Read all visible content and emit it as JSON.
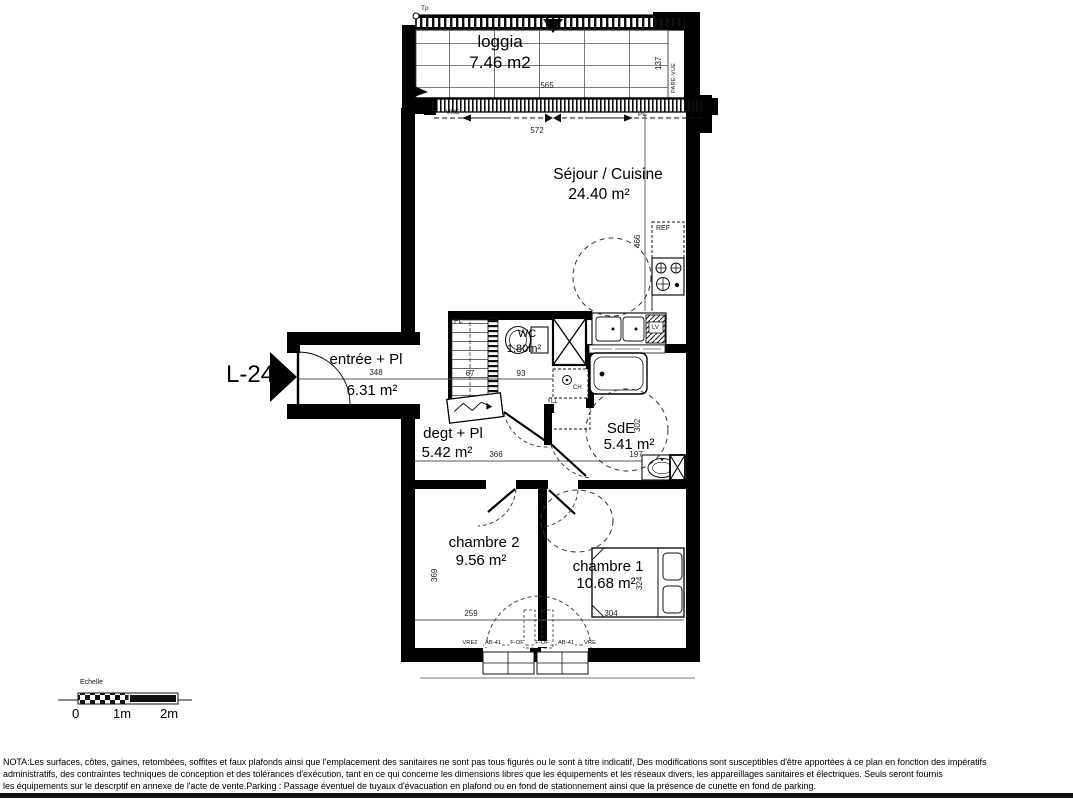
{
  "unit": "L-24",
  "rooms": {
    "loggia": {
      "name": "loggia",
      "area": "7.46 m2"
    },
    "sejour": {
      "name": "Séjour / Cuisine",
      "area": "24.40 m²"
    },
    "entree": {
      "name": "entrée + Pl",
      "area": "6.31 m²"
    },
    "wc": {
      "name": "WC",
      "area": "1.80m²"
    },
    "degt": {
      "name": "degt + Pl",
      "area": "5.42 m²"
    },
    "sde": {
      "name": "SdE",
      "area": "5.41 m²"
    },
    "chambre2": {
      "name": "chambre 2",
      "area": "9.56 m²"
    },
    "chambre1": {
      "name": "chambre 1",
      "area": "10.68 m²"
    }
  },
  "dims": {
    "d565": "565",
    "d137": "137",
    "d572": "572",
    "d466": "466",
    "d348": "348",
    "d67": "67",
    "d93": "93",
    "d366": "366",
    "d302": "302",
    "d197": "197",
    "d369": "369",
    "d259": "259",
    "d324": "324",
    "d304": "304"
  },
  "labels": {
    "tp": "Tp",
    "pare_vue": "PARE-VUE",
    "vre": "VRE",
    "pc": "PC",
    "ref": "REF",
    "lv": "LV",
    "ch": "CH",
    "ll": "LL",
    "pl": "PL"
  },
  "windows": [
    "VRE2",
    "AB-41",
    "F-OF",
    "F-OF",
    "AB-41",
    "VRE"
  ],
  "scale": {
    "title": "Echelle",
    "t0": "0",
    "t1": "1m",
    "t2": "2m"
  },
  "nota": {
    "l1": "NOTA:Les surfaces, côtes, gaines, retombées, soffites et faux plafonds ainsi que l'emplacement des sanitaires ne sont pas tous figurés ou le sont à titre indicatif, Des modifications sont susceptibles d'être apportées à ce plan en fonction des impératifs",
    "l2": "administratifs, des contraintes techniques de conception et des tolérances d'exécution, tant en ce qui concerne les dimensions libres que les équipements  et les réseaux divers, les appareillages sanitaires et électriques. Seuls seront fournis",
    "l3": "les équipements sur le descrptif en annexe de l'acte de vente.Parking : Passage éventuel de tuyaux d'évacuation en plafond ou en fond de stationnement ainsi que la présence de cunette en fond de parking."
  }
}
